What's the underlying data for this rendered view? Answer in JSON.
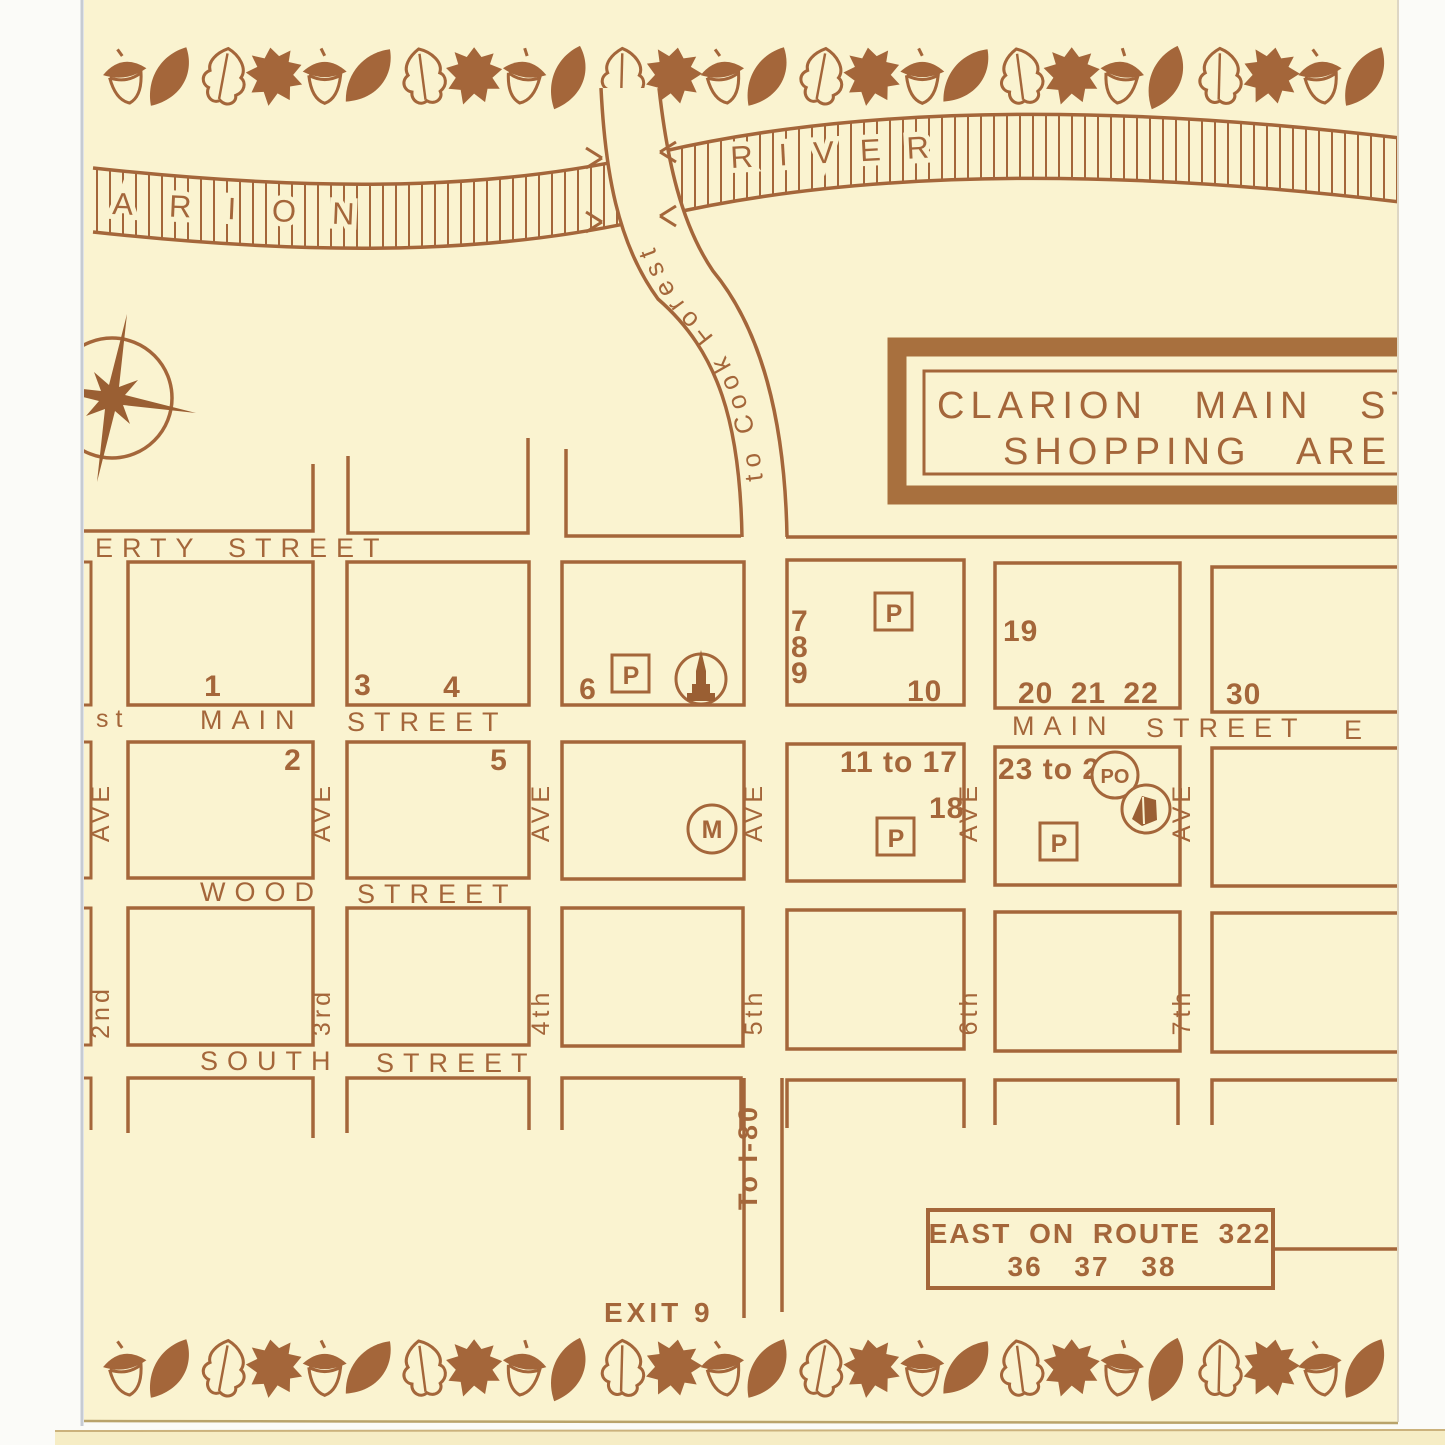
{
  "title_box": {
    "line1": "CLARION MAIN ST",
    "line2": "SHOPPING ARE"
  },
  "river": {
    "name_left_partial": "ARION",
    "name_right": "RIVER"
  },
  "roads": {
    "cook_forest": "to Cook Forest",
    "i80": "To I-80",
    "exit": "EXIT 9"
  },
  "route_box": {
    "line1": "EAST ON ROUTE 322",
    "line2": "36  37  38"
  },
  "streets": {
    "liberty_partial": "ERTY",
    "street_word": "STREET",
    "main_word": "MAIN",
    "wood_word": "WOOD",
    "south_word": "SOUTH",
    "first_partial": "st",
    "east_partial": "E"
  },
  "avenues": {
    "ave_word": "AVE",
    "n2": "2nd",
    "n3": "3rd",
    "n4": "4th",
    "n5": "5th",
    "n6": "6th",
    "n7": "7th"
  },
  "markers": {
    "parking": "P",
    "post_office": "PO",
    "m": "M"
  },
  "blocks": {
    "n1": "1",
    "n2": "2",
    "n3": "3",
    "n4": "4",
    "n5": "5",
    "n6": "6",
    "n7": "7",
    "n8": "8",
    "n9": "9",
    "n10": "10",
    "n11_17": "11 to 17",
    "n18": "18",
    "n19": "19",
    "n20_22": "20 21 22",
    "n23_29": "23 to 29",
    "n30": "30"
  }
}
